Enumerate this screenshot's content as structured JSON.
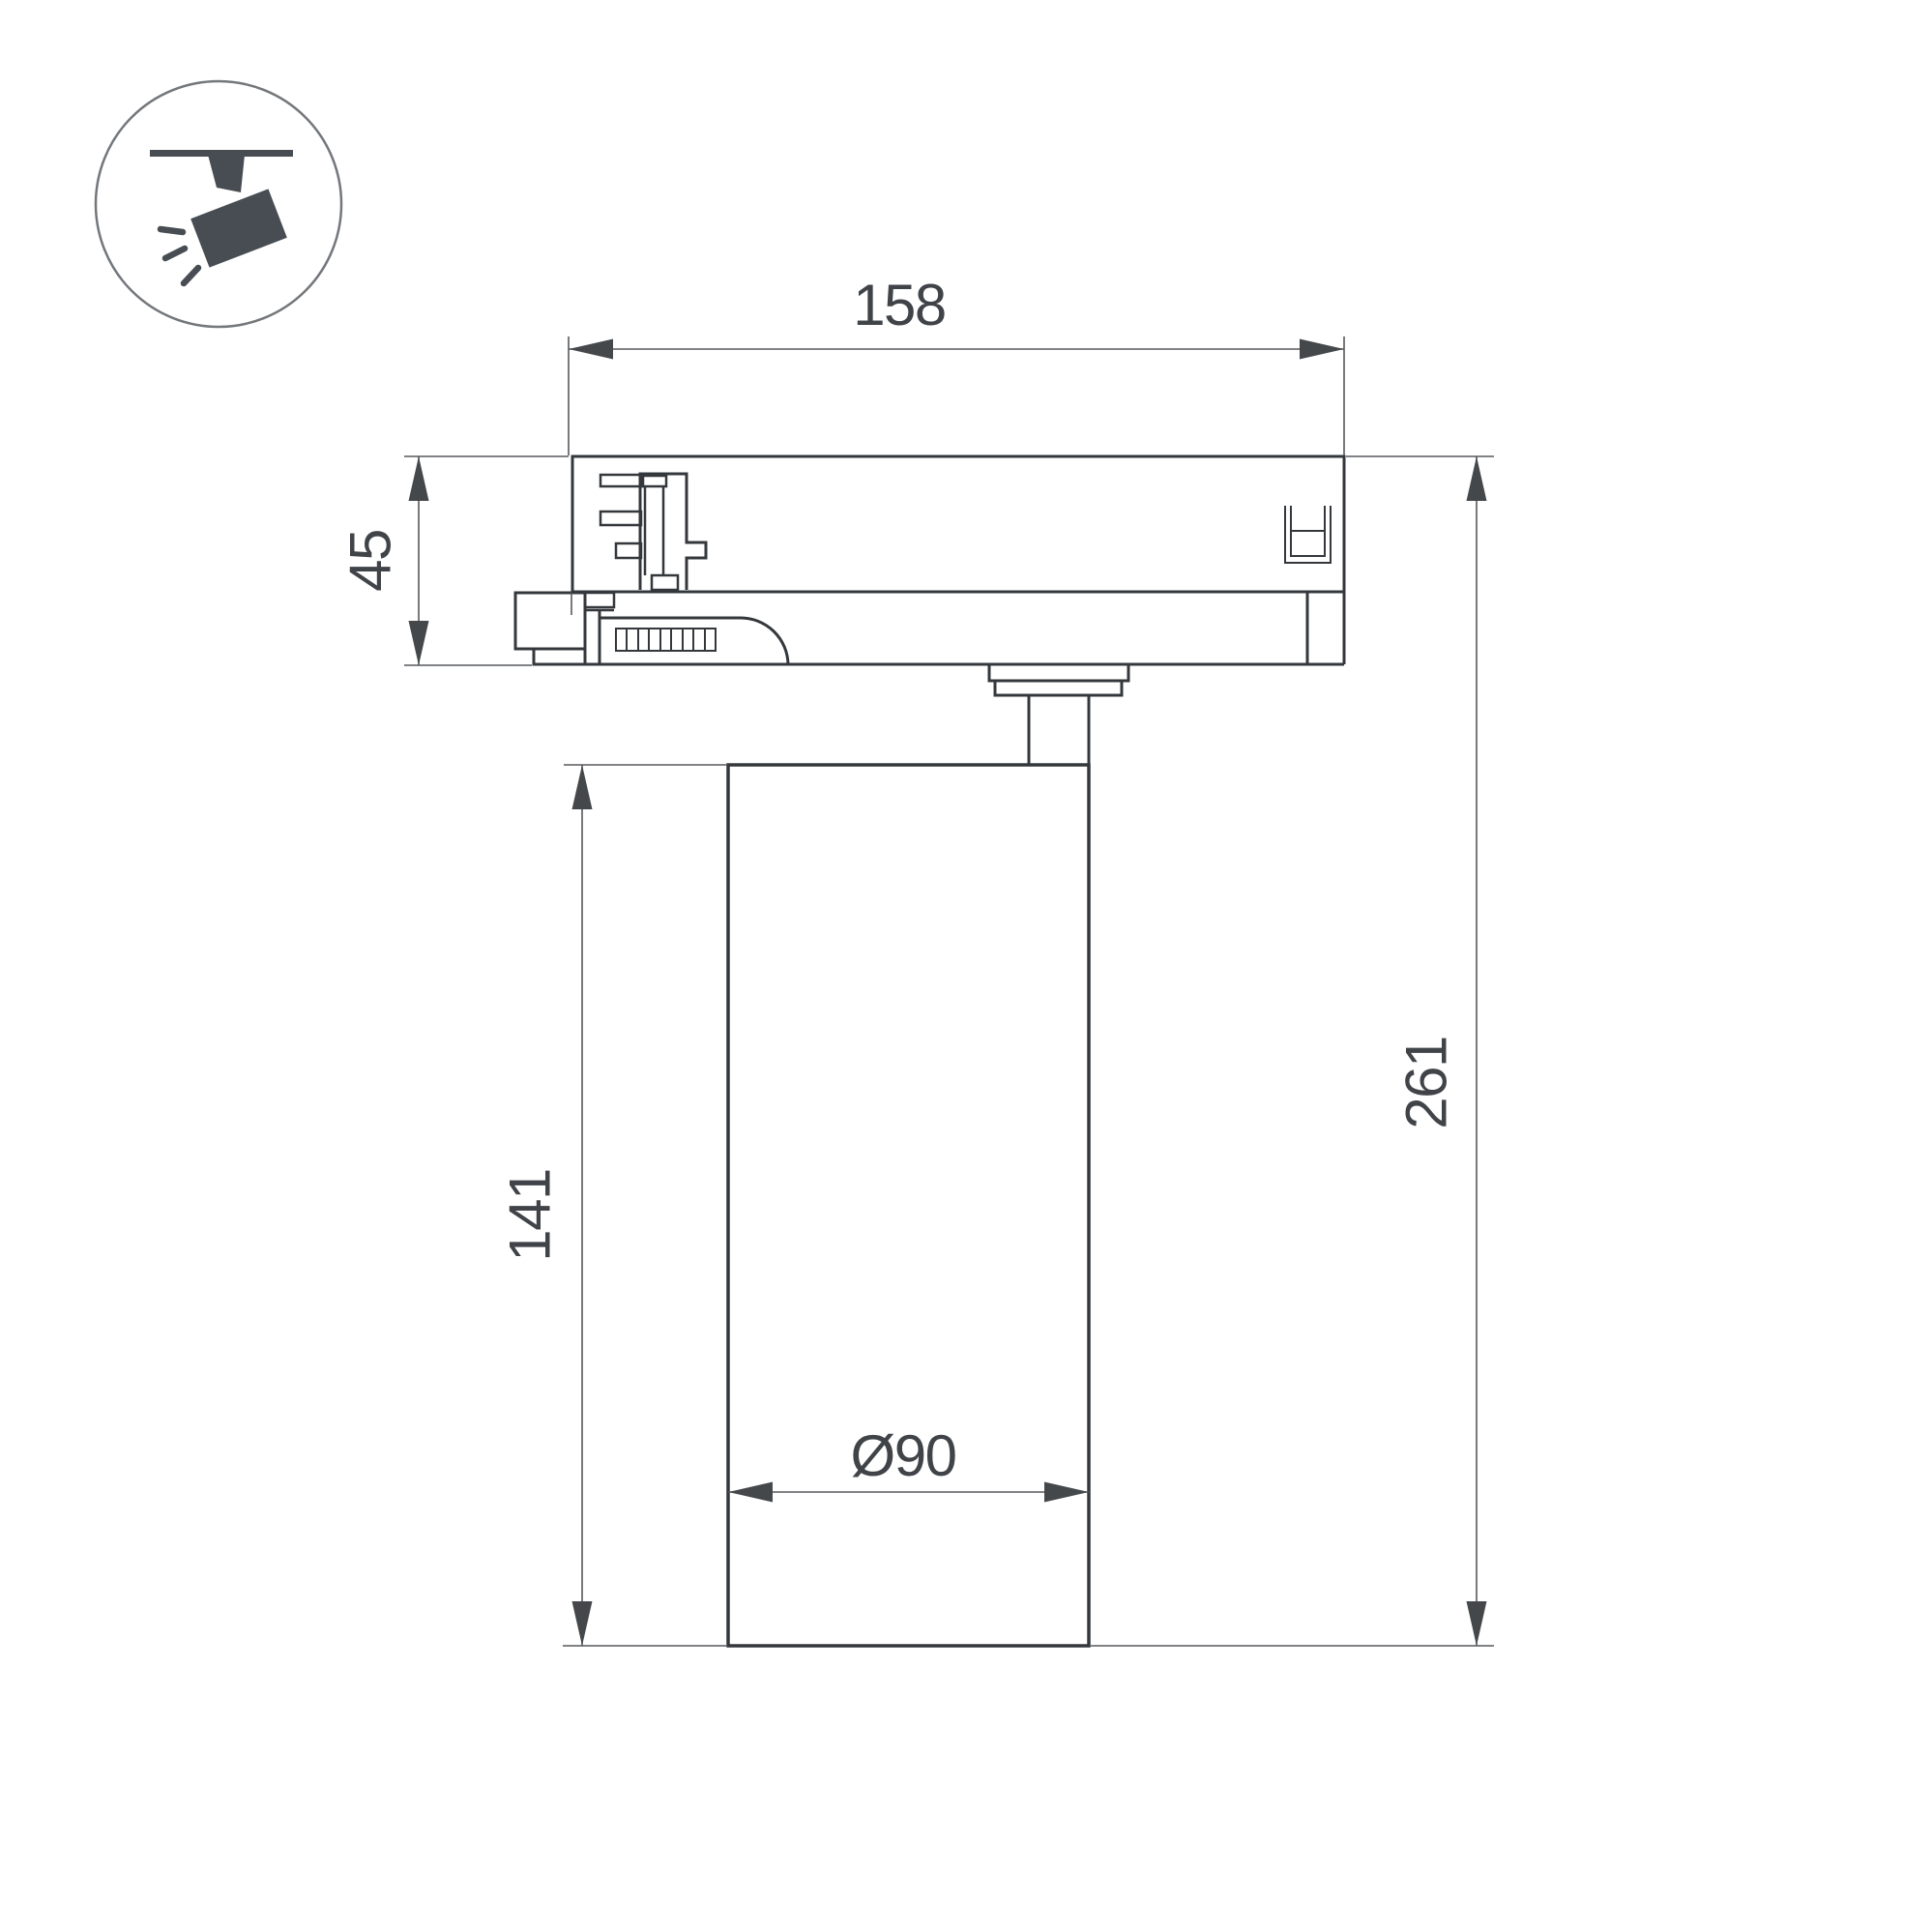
{
  "page": {
    "background": "#ffffff",
    "type": "technical-dimension-drawing",
    "subject": "track-spotlight-side-view"
  },
  "colors": {
    "part_outline": "#34383c",
    "dimension_line": "#56595d",
    "dimension_text": "#404448",
    "icon_fill": "#474d53",
    "icon_circle_stroke": "#73777b"
  },
  "icon": {
    "name": "track-spotlight-icon"
  },
  "dimensions": {
    "track_width": {
      "label": "158"
    },
    "adapter_height": {
      "label": "45"
    },
    "body_height": {
      "label": "141"
    },
    "total_height": {
      "label": "261"
    },
    "body_diameter": {
      "label": "Ø90"
    }
  }
}
